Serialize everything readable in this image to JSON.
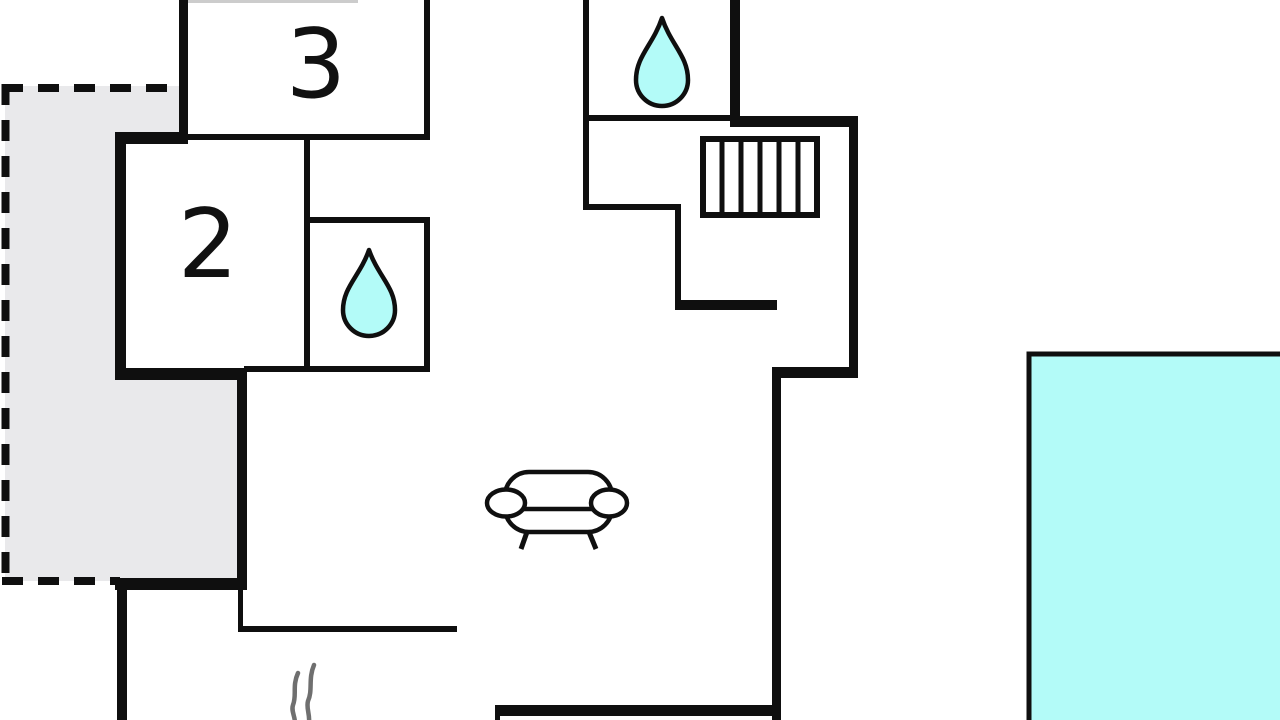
{
  "plan": {
    "name": "house-floor-plan",
    "rooms": [
      {
        "label": "3"
      },
      {
        "label": "2"
      }
    ],
    "icons": {
      "bathroom_upper": "water-drop-icon",
      "bathroom_lower": "water-drop-icon",
      "stairs": "staircase-icon",
      "living_room": "sofa-icon",
      "heat_source": "heat-waves-icon",
      "pool": "swimming-pool",
      "terrace": "dashed-terrace"
    },
    "colors": {
      "wall": "#0f0f0f",
      "water": "#b3fbf8",
      "terrace": "#e9e9eb",
      "heat": "#6f6f6f",
      "label": "#111111",
      "background": "#ffffff",
      "faint": "#cccccc"
    }
  }
}
